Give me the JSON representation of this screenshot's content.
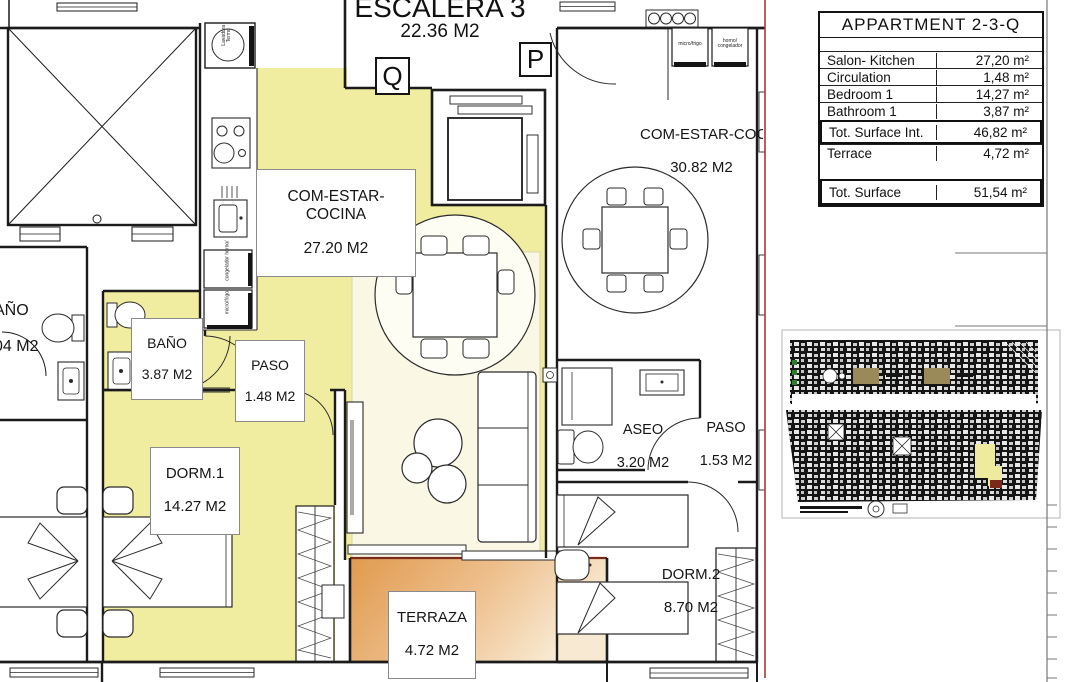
{
  "plan": {
    "stairwell": {
      "name": "ESCALERA 3",
      "area": "22.36 M2"
    },
    "markers": {
      "left": "Q",
      "right": "P"
    },
    "rooms": {
      "salon": {
        "name": "COM-ESTAR-COCINA",
        "area": "27.20 M2"
      },
      "bath": {
        "name": "BAÑO",
        "area": "3.87 M2"
      },
      "paso1": {
        "name": "PASO",
        "area": "1.48 M2"
      },
      "dorm1": {
        "name": "DORM.1",
        "area": "14.27 M2"
      },
      "terrace": {
        "name": "TERRAZA",
        "area": "4.72 M2"
      },
      "salon2": {
        "name": "COM-ESTAR-COC",
        "area": "30.82 M2"
      },
      "aseo": {
        "name": "ASEO",
        "area": "3.20 M2"
      },
      "paso2": {
        "name": "PASO",
        "area": "1.53 M2"
      },
      "dorm2": {
        "name": "DORM.2",
        "area": "8.70 M2"
      },
      "neighbor_bath": {
        "name": "AÑO",
        "area": "04 M2"
      }
    },
    "appliances": {
      "washer": "Lavadora Termo",
      "oven_freezer_left": "congelador horno/",
      "fridge_micro_left": "micro/frigo",
      "fridge_micro_right": "micro/frigo",
      "oven_freezer_right": "horno/ congelador"
    },
    "colors": {
      "room_highlight": "#f1eda0",
      "living_pale": "#faf8e4",
      "terrace_dark": "#e09a4e",
      "terrace_light": "#f8ead2",
      "section_line": "#a83a2a",
      "wall": "#1b1b1b"
    }
  },
  "summary_table": {
    "title": "APPARTMENT 2-3-Q",
    "rows": [
      {
        "label": "Salon- Kitchen",
        "value": "27,20 m²"
      },
      {
        "label": "Circulation",
        "value": "1,48 m²"
      },
      {
        "label": "Bedroom 1",
        "value": "14,27 m²"
      },
      {
        "label": "Bathroom 1",
        "value": "3,87 m²"
      },
      {
        "label": "Tot. Surface Int.",
        "value": "46,82 m²"
      },
      {
        "label": "Terrace",
        "value": "4,72 m²"
      },
      {
        "label": "Tot. Surface",
        "value": "51,54 m²"
      }
    ]
  }
}
